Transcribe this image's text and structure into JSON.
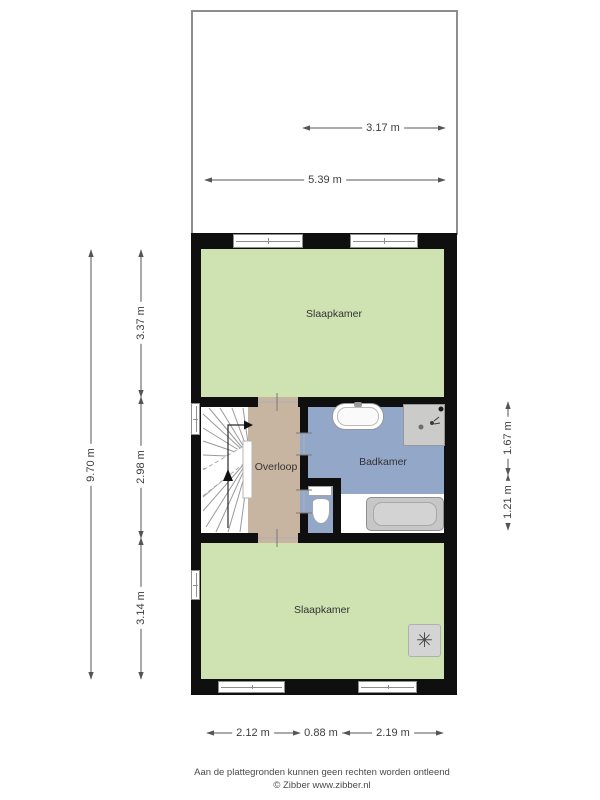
{
  "attic": {
    "dim_inner": "3.17 m",
    "dim_full": "5.39 m"
  },
  "rooms": {
    "bedroom_top": "Slaapkamer",
    "landing": "Overloop",
    "bathroom": "Badkamer",
    "bedroom_bottom": "Slaapkamer"
  },
  "dims_left": {
    "total": "9.70 m",
    "top": "3.37 m",
    "middle": "2.98 m",
    "bottom": "3.14 m"
  },
  "dims_right": {
    "top": "1.67 m",
    "bottom": "1.21 m"
  },
  "dims_bottom": {
    "left": "2.12 m",
    "middle": "0.88 m",
    "right": "2.19 m"
  },
  "icons": {
    "ventilation": "✳"
  },
  "colors": {
    "room_green": "#cfe2b2",
    "landing_tan": "#c8b5a1",
    "bathroom_blue": "#93a7c9",
    "wall_black": "#0f0f0f",
    "fixture_gray": "#cbcbca"
  },
  "footer": {
    "disclaimer": "Aan de plattegronden kunnen geen rechten worden ontleend",
    "copyright": "© Zibber www.zibber.nl"
  }
}
